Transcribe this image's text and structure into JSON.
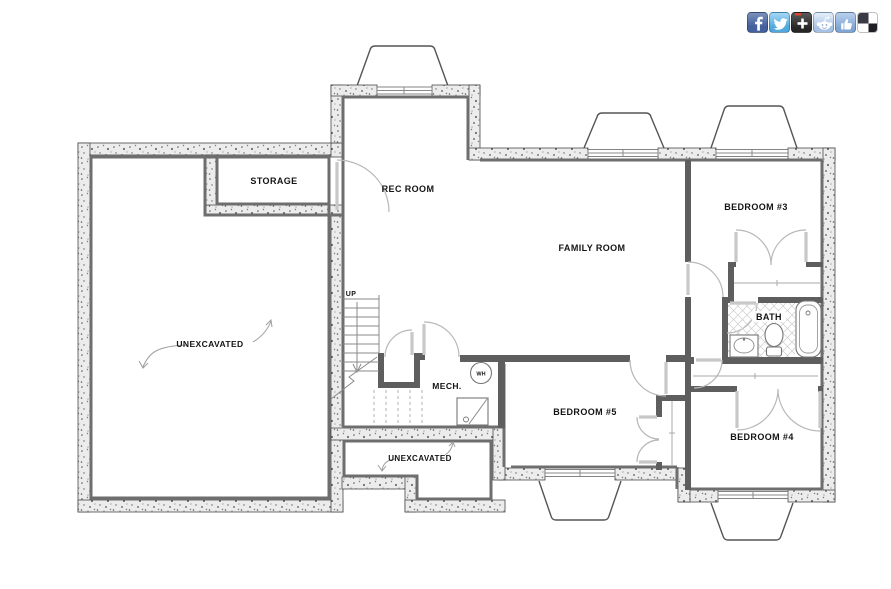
{
  "page": {
    "background_color": "#ffffff"
  },
  "social_toolbar": {
    "icons": [
      {
        "name": "facebook",
        "color": "#3b5998"
      },
      {
        "name": "twitter",
        "color": "#5ea9dd"
      },
      {
        "name": "share-plus",
        "color": "#2e2e2e"
      },
      {
        "name": "reddit",
        "color": "#b6cdea"
      },
      {
        "name": "thumbs-up",
        "color": "#8fb1dc"
      },
      {
        "name": "checkerboard",
        "color": "#2b2b33"
      }
    ]
  },
  "floor_plan": {
    "labels": {
      "storage": "STORAGE",
      "rec_room": "REC ROOM",
      "family_room": "FAMILY ROOM",
      "bedroom_3": "BEDROOM #3",
      "bath": "BATH",
      "mech": "MECH.",
      "water_heater": "WH",
      "bedroom_5": "BEDROOM #5",
      "bedroom_4": "BEDROOM #4",
      "unexcavated_left": "UNEXCAVATED",
      "unexcavated_bottom": "UNEXCAVATED",
      "stair_direction": "UP"
    },
    "colors": {
      "wall_fill": "#ececec",
      "wall_speckle": "#555555",
      "wall_inner_face": "#6e6e6e",
      "drawing_line": "#9e9e9e",
      "text": "#141414"
    }
  }
}
